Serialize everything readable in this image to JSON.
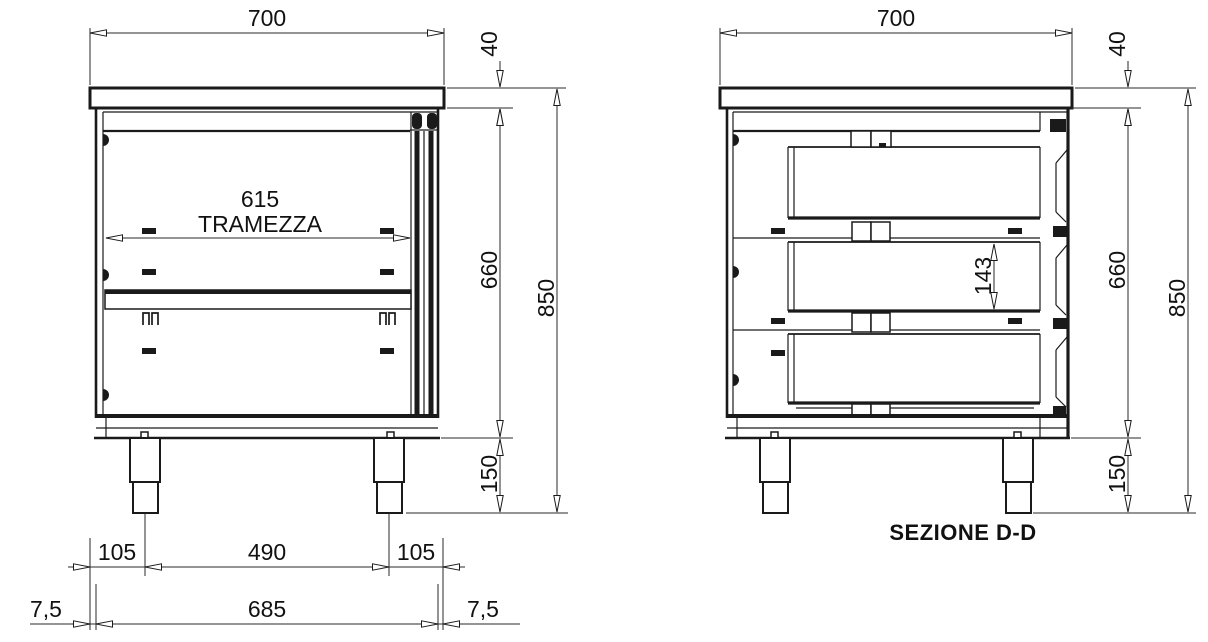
{
  "colors": {
    "ink": "#1a1a1a",
    "paper": "#ffffff"
  },
  "front_view": {
    "dim_top_width": "700",
    "dim_top_thickness": "40",
    "dim_partition_width": "615",
    "partition_label": "TRAMEZZA",
    "dim_body_height": "660",
    "dim_total_height": "850",
    "dim_leg_height": "150",
    "dim_leg_offset_left": "105",
    "dim_leg_spacing": "490",
    "dim_leg_offset_right": "105",
    "dim_base_width": "685",
    "dim_overhang_left": "7,5",
    "dim_overhang_right": "7,5"
  },
  "section_view": {
    "caption": "SEZIONE D-D",
    "dim_top_width": "700",
    "dim_top_thickness": "40",
    "dim_drawer_inner_height": "143",
    "dim_body_height": "660",
    "dim_total_height": "850",
    "dim_leg_height": "150"
  }
}
